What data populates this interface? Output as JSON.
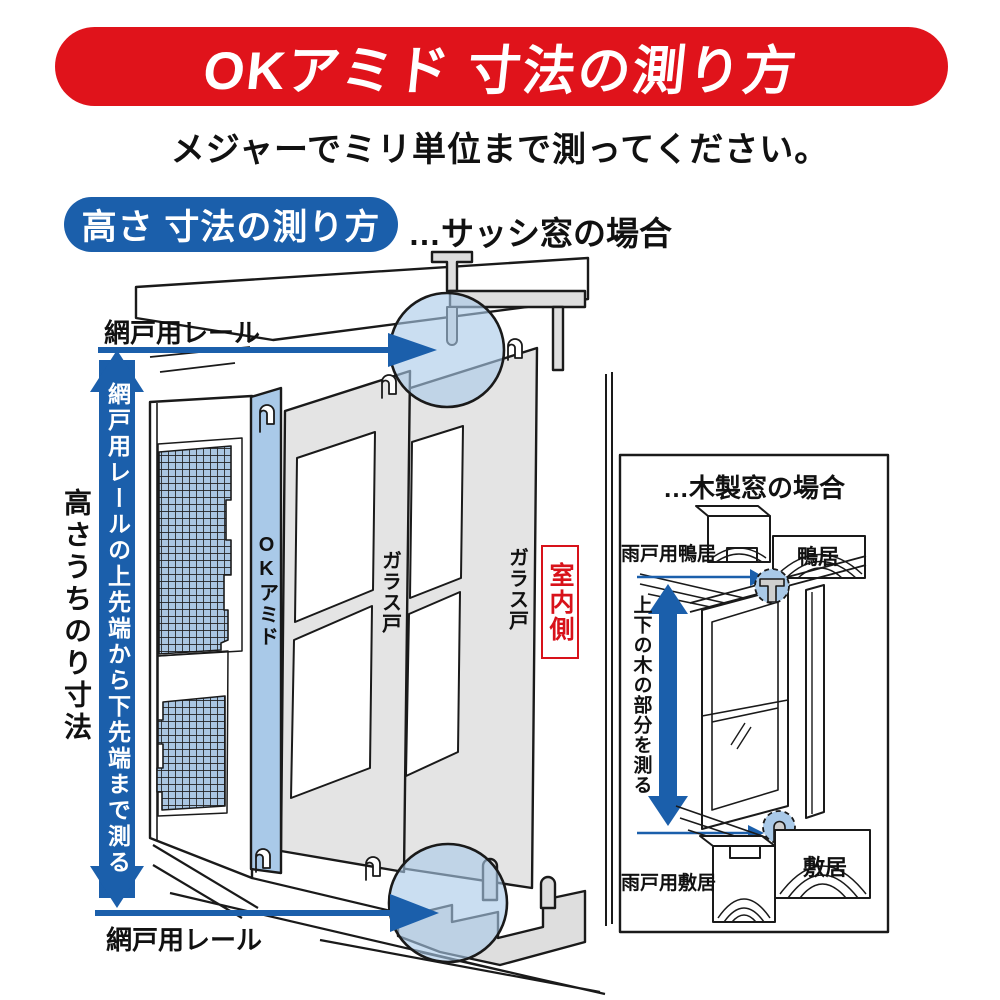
{
  "header": {
    "title": "OKアミド 寸法の測り方",
    "subtitle": "メジャーでミリ単位まで測ってください。"
  },
  "section": {
    "badge": "高さ 寸法の測り方",
    "case_note": "…サッシ窓の場合"
  },
  "main_diagram": {
    "label_top_rail": "網戸用レール",
    "label_bottom_rail": "網戸用レール",
    "arrow_instruction": "網戸用レールの上先端から下先端まで測る",
    "label_height_dimension": "高さうちのり寸法",
    "label_screen_door": "OKアミド",
    "label_glass_door_1": "ガラス戸",
    "label_glass_door_2": "ガラス戸",
    "label_indoor_side": "室内側"
  },
  "wooden_window_panel": {
    "title": "…木製窓の場合",
    "label_storm_door_kamoi": "雨戸用鴨居",
    "label_kamoi": "鴨居",
    "arrow_instruction": "上下の木の部分を測る",
    "label_storm_door_shikii": "雨戸用敷居",
    "label_shikii": "敷居"
  },
  "icons": {
    "measure_arrows": "double-headed-arrow-icon",
    "detail_highlight": "magnifier-circle-icon"
  },
  "colors": {
    "banner_red": "#e0131b",
    "accent_blue": "#1b5fab",
    "highlight_blue": "#a9c9e8",
    "mesh_blue": "#aac6e2",
    "door_gray": "#e4e4e4",
    "indoor_red": "#d8121a",
    "line_black": "#1a1a1a"
  }
}
